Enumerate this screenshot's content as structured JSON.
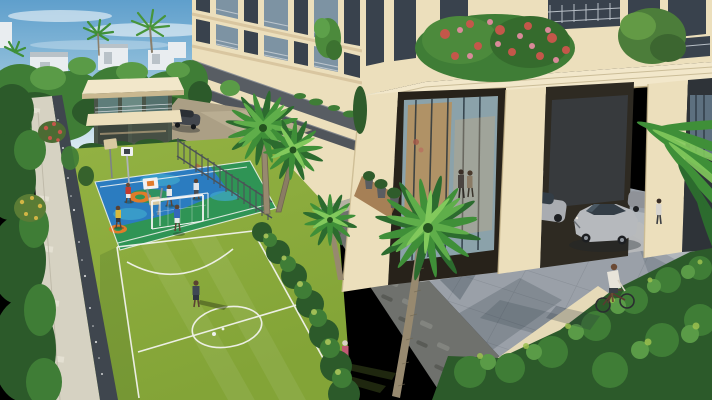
{
  "meta": {
    "title": "aerial-render-residential-complex",
    "type": "architectural-3d-visualization",
    "view": "elevated three-quarter aerial view, daytime"
  },
  "palette": {
    "sky_top": "#5f9fcc",
    "sky_mid": "#9cc6de",
    "sky_horizon": "#dcebf2",
    "cloud": "#ffffff",
    "foliage_dark": "#2c5a2a",
    "foliage_mid": "#3f7d36",
    "foliage_light": "#5a9b47",
    "foliage_bright": "#7ab94f",
    "villa_white": "#e9edf0",
    "villa_shade": "#b9c2c8",
    "building_cream": "#ecdfbc",
    "building_cream_dark": "#d9c6a0",
    "cornice_cream": "#f2e7ca",
    "cladding_dark": "#585d63",
    "window_dark": "#39424d",
    "glass_blue": "#7d93a3",
    "railing_light": "#c5ccd3",
    "portico_interior": "#27221a",
    "lobby_glass": "#9db8c4",
    "lobby_wood": "#b4905e",
    "lobby_floor": "#b9babb",
    "fence_grey": "#4c5257",
    "path_brown": "#a9713f",
    "court_green": "#2f9455",
    "court_blue": "#2b7cc0",
    "court_cyan": "#3fa9cd",
    "court_orange": "#e07b2a",
    "line_white": "#f5f5f2",
    "turf": "#8aa93c",
    "lawn": "#6f9c3f",
    "wall_cream": "#d6d2c2",
    "wall_stone": "#3f464e",
    "stone_wall": "#6f716d",
    "pavement": "#9aa0a8",
    "pavement_light": "#b8bdc2",
    "parapet": "#e6dab8",
    "car_silver": "#b6b9bd",
    "car_dark_grey": "#42464d",
    "trunk": "#97896f",
    "palm_dark": "#2c6b2e",
    "palm_mid": "#3f8f38",
    "palm_light": "#5fae4a",
    "palm_bright": "#82c95c",
    "flower_red": "#c4574a",
    "flower_pink": "#d98a99",
    "flower_yellow": "#d2b545",
    "shadow": "#22313c"
  },
  "scene": {
    "architecture": [
      "cream multi-storey residential tower with grey stone cladding bands",
      "grand double-height entrance portico with stepped cornice",
      "glass lobby with wooden feature wall",
      "clubhouse pavilion with flat canopy roof and glass facade",
      "cream boundary wall with dark gravel coping",
      "dark stacked-stone retaining wall",
      "paver-block driveway",
      "background villas among trees"
    ],
    "amenities": [
      "multi-sport basketball court in blue, green and orange",
      "two basketball hoop units and a practice board",
      "artificial-turf soccer field with white markings",
      "white soccer goal",
      "metal picket fence along walkway",
      "brown tiled garden path"
    ],
    "vehicles": [
      "dark grey car on upper driveway",
      "silver sedan at portico drop-off",
      "second silver car under portico",
      "third car glimpsed behind column",
      "bicycle ridden across driveway"
    ],
    "figures": [
      "basketball player in red jersey",
      "basketball player in yellow jersey",
      "two basketball players in white",
      "goalkeeper in blue in front of goal",
      "soccer player in dark shirt at midfield",
      "man in grey walking on turf",
      "woman in pink walking on turf",
      "person in red on garden path",
      "couple standing in glass lobby",
      "cyclist in white shirt",
      "person standing beside parked car"
    ],
    "vegetation": [
      "foreground fan palms",
      "background coconut palms",
      "flowering bush with red-pink blooms on portico cornice",
      "red and yellow flowering shrubs beyond boundary wall",
      "dense dark-green hedges at lower right"
    ]
  }
}
